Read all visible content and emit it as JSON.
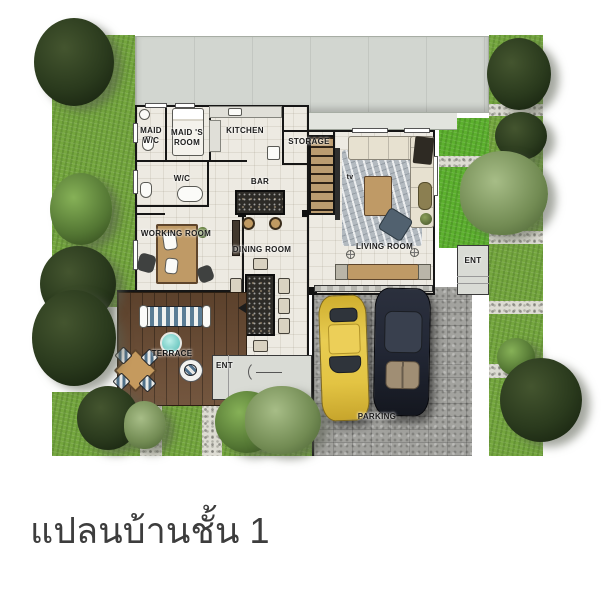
{
  "title": "แปลนบ้านชั้น 1",
  "plan": {
    "labels": {
      "maid_wc": "MAID\nW/C",
      "maids_room": "MAID 'S\nROOM",
      "kitchen": "KITCHEN",
      "storage": "STORAGE",
      "wc": "W/C",
      "bar": "BAR",
      "working_room": "WORKING ROOM",
      "dining_room": "DINING ROOM",
      "living_room": "LIVING ROOM",
      "terrace": "TERRACE",
      "parking": "PARKING",
      "tv": "tv",
      "ent_main": "ENT",
      "ent_side": "ENT"
    },
    "colors": {
      "roof": "#d2d6d0",
      "floor": "#edeae2",
      "wall": "#161616",
      "grass": "#74a63e",
      "grass_bright": "#5cb02e",
      "gravel": "#dddcd3",
      "stone_parking": "#a2a29e",
      "wood_deck": "#6b4c33",
      "yellow_car": "#e3c443",
      "dark_car": "#232836",
      "teal_table": "#5fc4bd",
      "title_text": "#3d3d3d"
    }
  }
}
